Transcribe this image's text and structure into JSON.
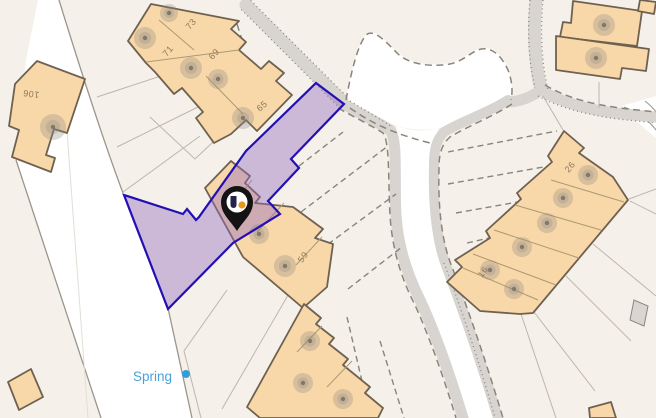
{
  "map": {
    "labels": {
      "h106": "106",
      "h71": "71",
      "h73": "73",
      "h69": "69",
      "h65": "65",
      "h59": "59",
      "h26": "26",
      "h16": "16"
    },
    "spring_label": "Spring",
    "marker": {
      "type": "property-location-pin"
    },
    "colors": {
      "background": "#f5f1ea",
      "road": "#ffffff",
      "road_edge": "#9b968c",
      "road_edge_faint": "#e3ded5",
      "path_fill": "#d8d5d0",
      "dash": "#8a857b",
      "lot_line": "#bcb6ab",
      "building_fill": "#f8d7a9",
      "building_stroke": "#6f6150",
      "divider": "#ad9a72",
      "plot_fill": "rgba(147,108,190,0.42)",
      "plot_stroke": "#2310b5",
      "house_number": "#8a7a5c",
      "spring_text": "#4aa3d8",
      "spring_dot": "#2e9fd8",
      "marker_black": "#131313",
      "marker_logo_dark": "#232347",
      "marker_logo_orange": "#e5971f",
      "tree_outer": "rgba(140,134,125,0.30)",
      "tree_mid": "rgba(140,134,125,0.25)",
      "tree_dot": "#7e786f"
    }
  }
}
